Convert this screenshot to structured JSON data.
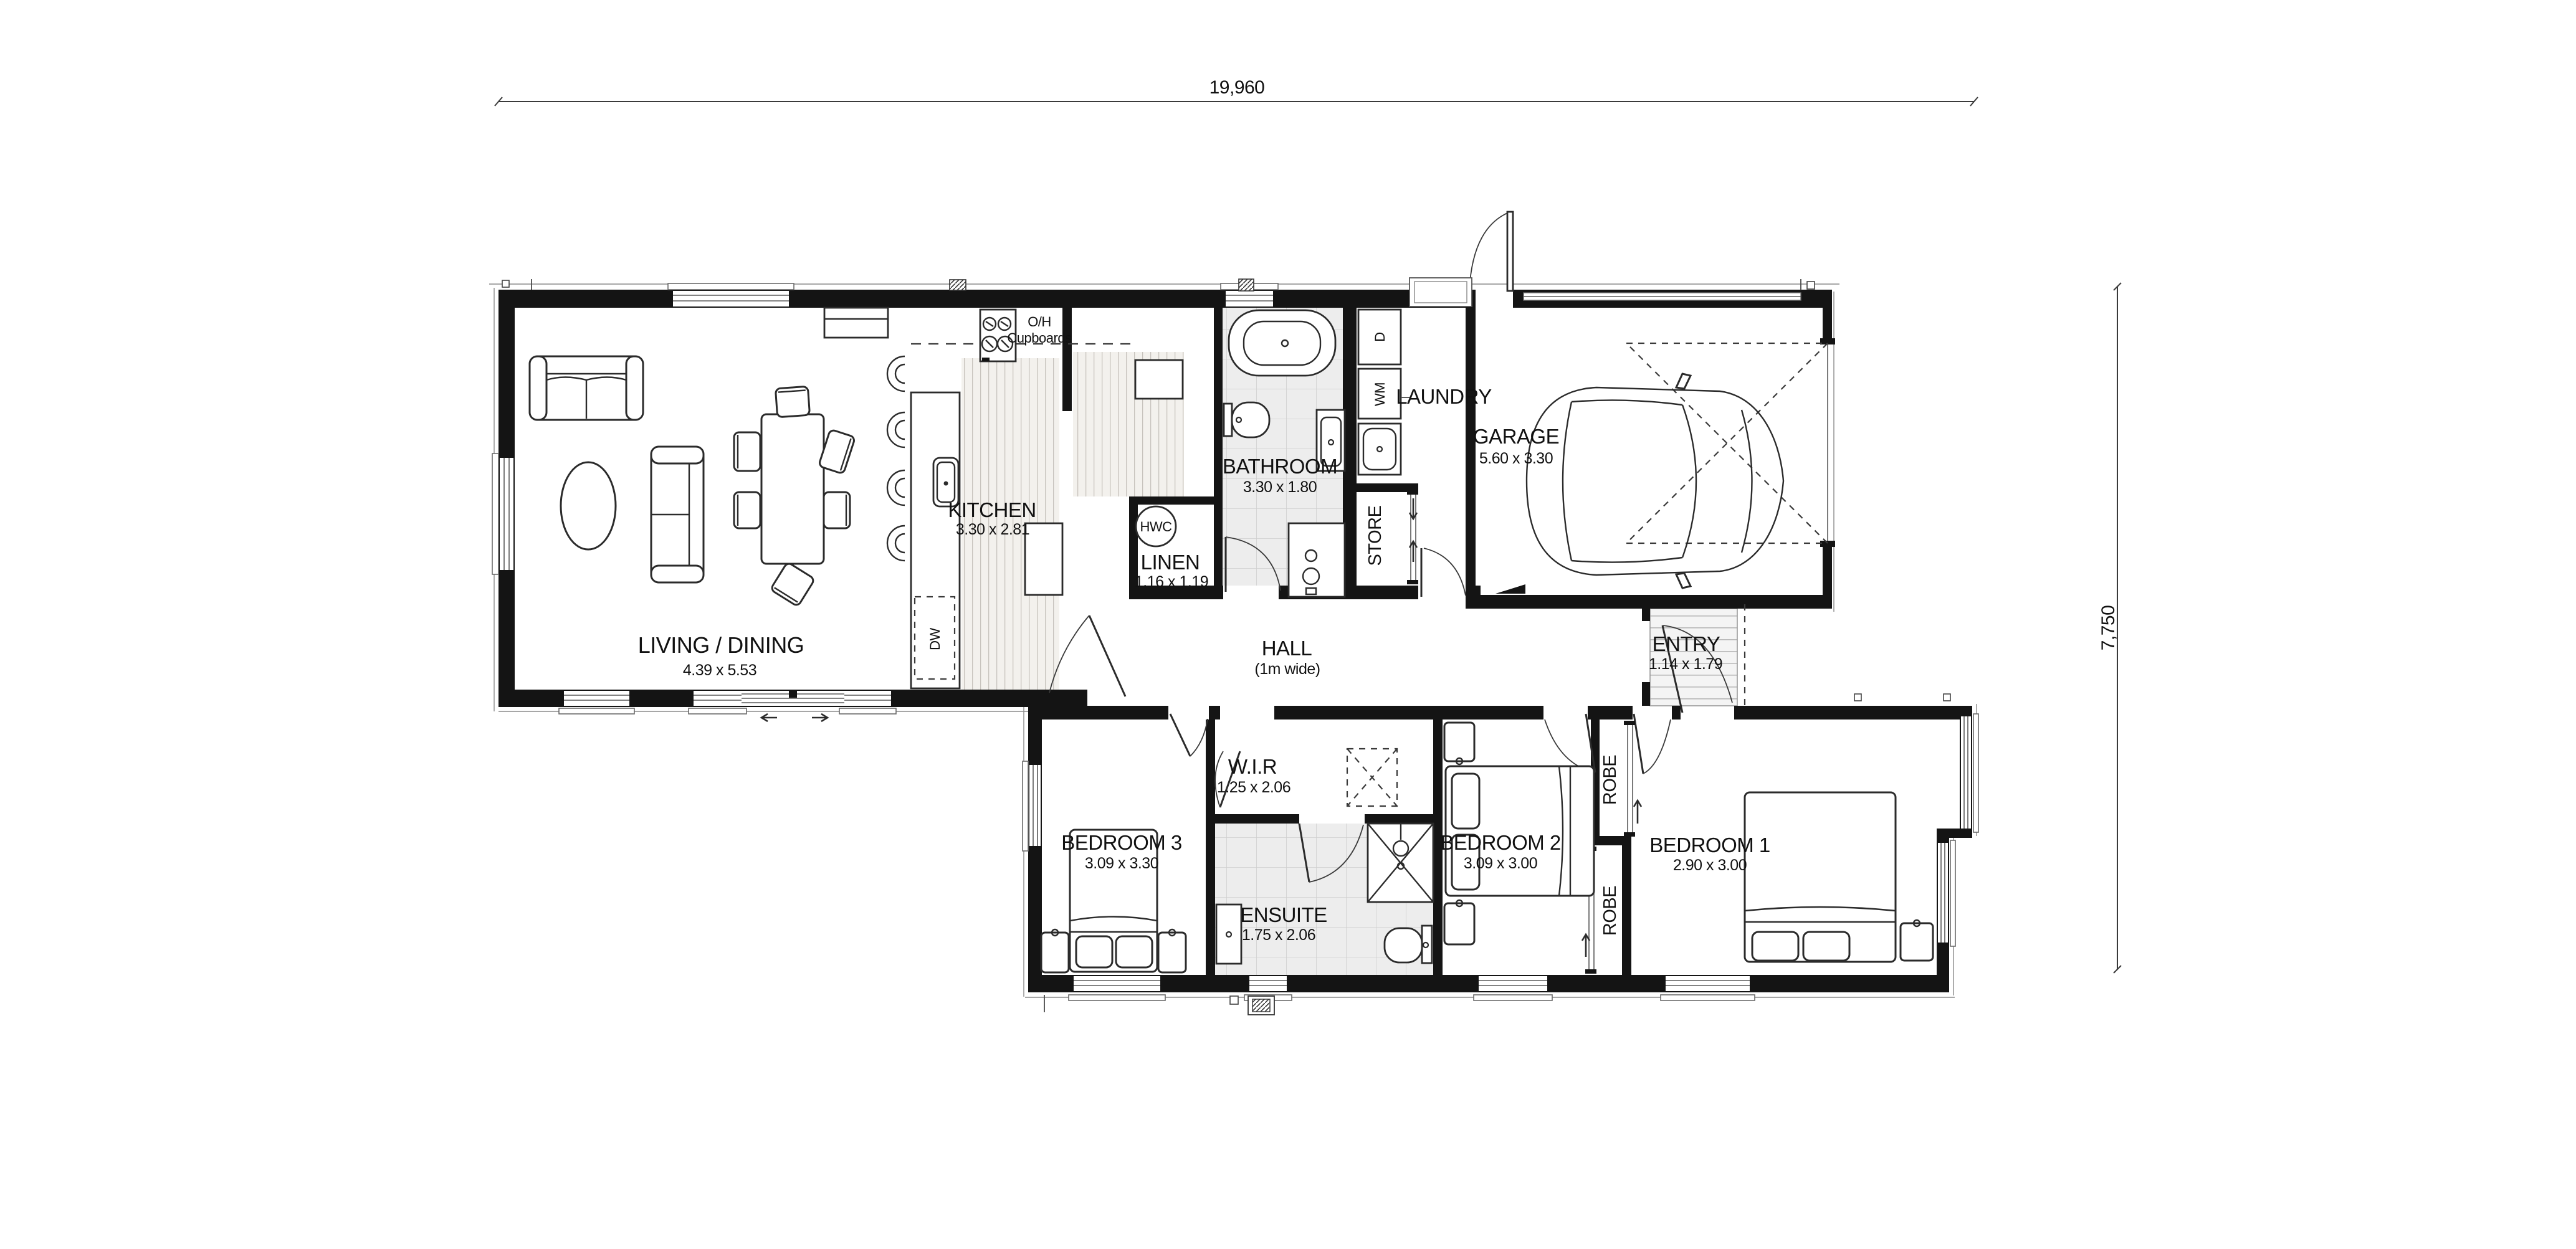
{
  "dimensions": {
    "top": "19,960",
    "right": "7,750"
  },
  "rooms": {
    "living": {
      "label": "LIVING / DINING",
      "dims": "4.39 x 5.53"
    },
    "kitchen": {
      "label": "KITCHEN",
      "dims": "3.30 x 2.81"
    },
    "bathroom": {
      "label": "BATHROOM",
      "dims": "3.30 x 1.80"
    },
    "linen": {
      "label": "LINEN",
      "dims": "1.16 x 1.19"
    },
    "laundry": {
      "label": "LAUNDRY"
    },
    "store": {
      "label": "STORE"
    },
    "garage": {
      "label": "GARAGE",
      "dims": "5.60 x 3.30"
    },
    "hall": {
      "label": "HALL",
      "dims": "(1m wide)"
    },
    "entry": {
      "label": "ENTRY",
      "dims": "1.14 x 1.79"
    },
    "wir": {
      "label": "W.I.R",
      "dims": "1.25 x 2.06"
    },
    "ensuite": {
      "label": "ENSUITE",
      "dims": "1.75 x 2.06"
    },
    "bedroom3": {
      "label": "BEDROOM 3",
      "dims": "3.09 x 3.30"
    },
    "bedroom2": {
      "label": "BEDROOM 2",
      "dims": "3.09 x 3.00"
    },
    "bedroom1": {
      "label": "BEDROOM 1",
      "dims": "2.90 x 3.00"
    },
    "robe_top": {
      "label": "ROBE"
    },
    "robe_bottom": {
      "label": "ROBE"
    }
  },
  "fixtures": {
    "hwc": "HWC",
    "dw": "DW",
    "wm": "WM",
    "dryer": "D",
    "oh_line1": "O/H",
    "oh_line2": "Cupboards"
  }
}
